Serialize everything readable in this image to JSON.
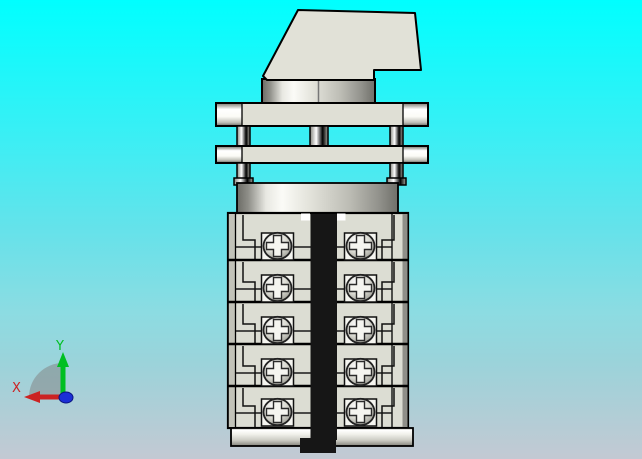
{
  "viewport": {
    "width": 642,
    "height": 459,
    "background_gradient_stops": [
      "#00ffff",
      "#41edf3",
      "#65e2ea",
      "#8cdce2",
      "#9bd3da",
      "#c3c9d3"
    ]
  },
  "axis_triad": {
    "x_label": "X",
    "y_label": "Y",
    "x_color": "#cc2222",
    "y_color": "#00bf22",
    "z_dot_color": "#1b2fd6",
    "shadow_color": "#808080"
  },
  "model": {
    "kind": "rotary-cam-switch-3d-model",
    "colors": {
      "part_fill": "#e1e1d7",
      "plate_fill": "#dfdfd5",
      "wafer_fill": "#dcddd3",
      "wafer_side_left": "#c2c3b9",
      "wafer_side_right": "#8f8f89",
      "pad_fill": "#f5f5f0",
      "strip": "#161616",
      "outline": "#000000"
    },
    "terminal_stack": {
      "row_count": 5,
      "screws_per_row": 2,
      "screw_total": 10,
      "left": 228,
      "right": 408,
      "face_left": 236,
      "face_right": 392,
      "rows": [
        {
          "top": 213,
          "bottom": 260,
          "screw_y": 246
        },
        {
          "top": 260,
          "bottom": 302,
          "screw_y": 288
        },
        {
          "top": 302,
          "bottom": 344,
          "screw_y": 330
        },
        {
          "top": 344,
          "bottom": 386,
          "screw_y": 372
        },
        {
          "top": 386,
          "bottom": 428,
          "screw_y": 412
        }
      ],
      "screw_columns_x": [
        277.5,
        360.5
      ]
    }
  }
}
